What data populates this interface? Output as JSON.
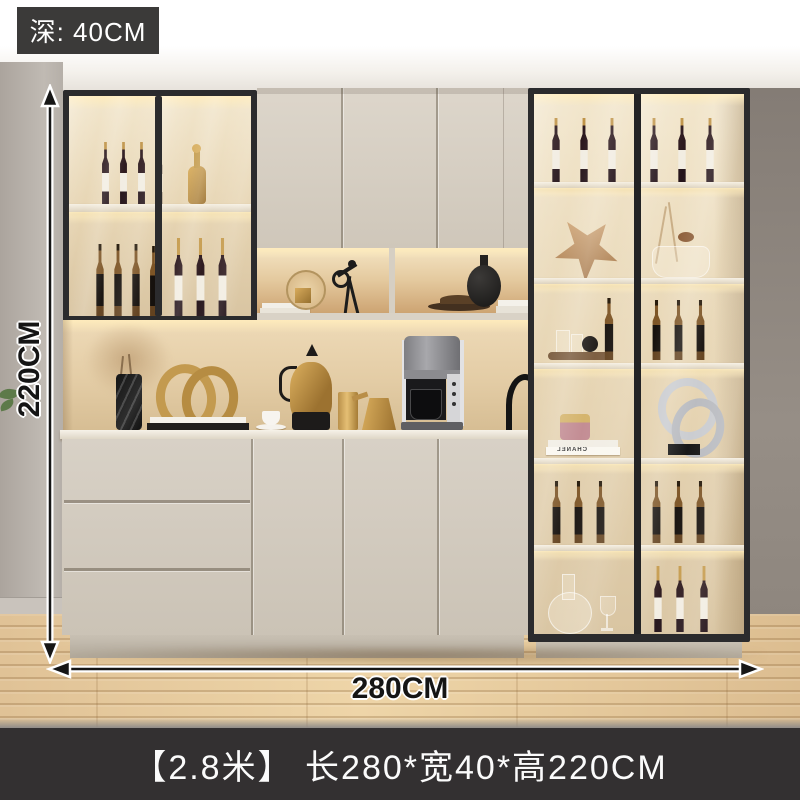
{
  "annotations": {
    "depth_badge": "深: 40CM",
    "height_label": "220CM",
    "width_label": "280CM",
    "caption": "【2.8米】 长280*宽40*高220CM",
    "height_arrow": "vertical-double-arrow",
    "width_arrow": "horizontal-double-arrow"
  },
  "decor_text": {
    "book_spine": "CHANEL"
  },
  "colors": {
    "badge_bg": "#3b3a39",
    "caption_bar_bg": "#333031",
    "annotation_text": "#151515",
    "cabinet_frame": "#2b2b2d",
    "cabinet_beige": "#d6cfc4",
    "interior_glow": "#f2e3c4",
    "gold_accent": "#c79a4e",
    "floor_wood": "#e3c79b",
    "wall_left": "#b7b1ab",
    "wall_right": "#8e8680"
  }
}
